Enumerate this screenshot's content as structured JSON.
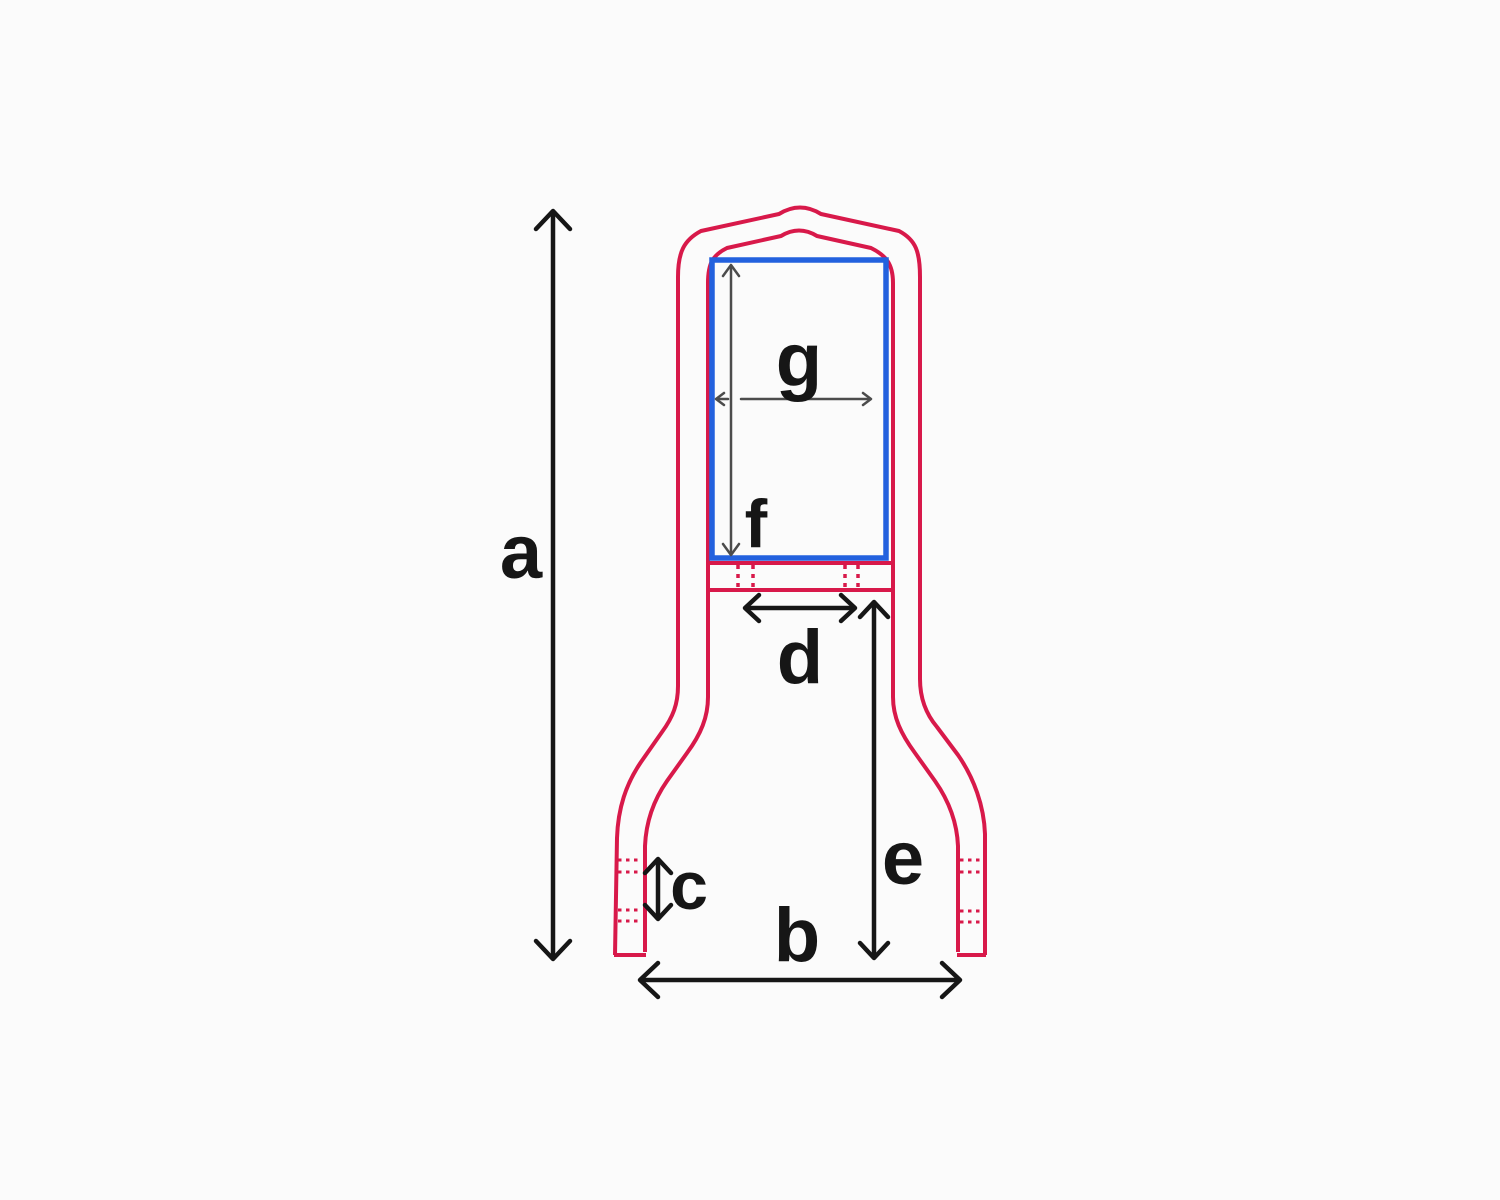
{
  "colors": {
    "background": "#fbfbfb",
    "outline_red": "#d8194a",
    "pad_blue": "#2361de",
    "dimension_black": "#161616",
    "pad_dimension_gray": "#4c4c4c"
  },
  "dimension_labels": {
    "a": "a",
    "b": "b",
    "c": "c",
    "d": "d",
    "e": "e",
    "f": "f",
    "g": "g"
  }
}
